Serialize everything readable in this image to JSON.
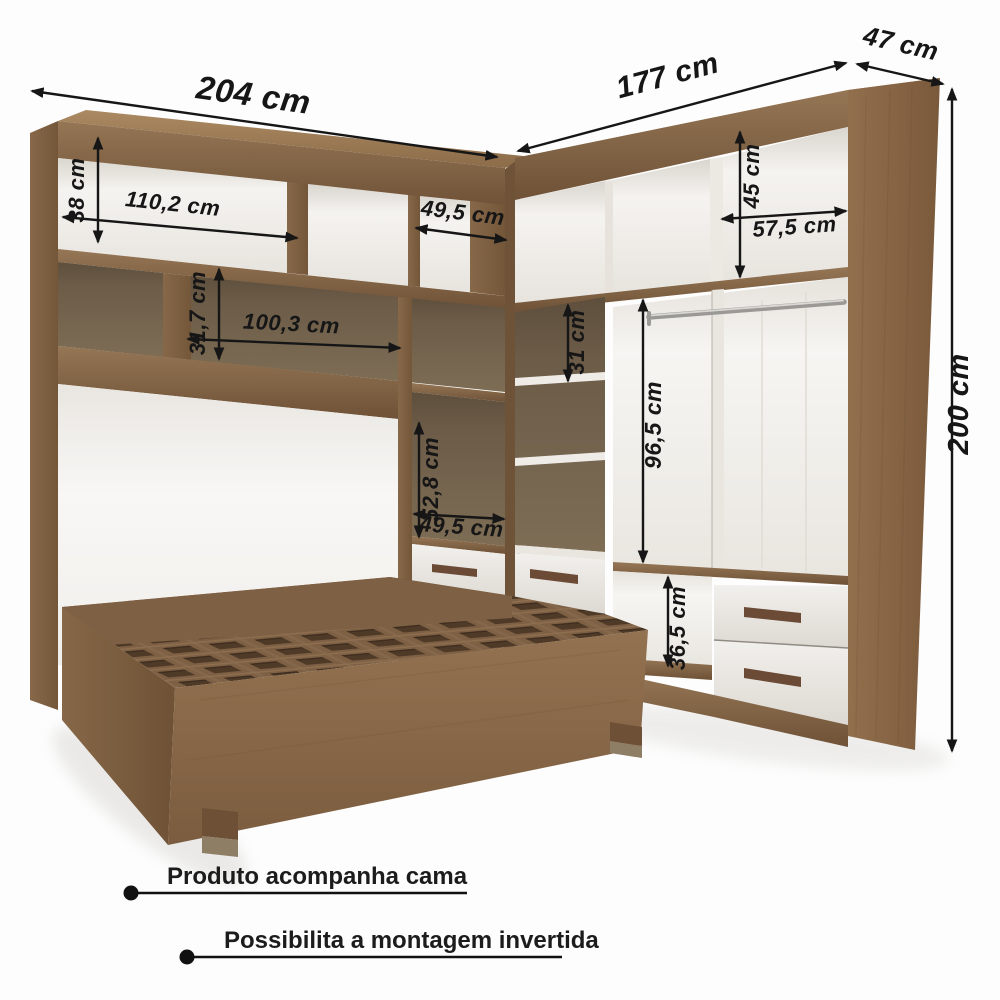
{
  "dimensions": {
    "left_width": "204 cm",
    "right_width": "177 cm",
    "right_depth": "47 cm",
    "height": "200 cm",
    "top_cubby_height": "38 cm",
    "top_cubby_width": "110,2 cm",
    "top_small_cubby_width": "49,5 cm",
    "right_cubby_height": "45 cm",
    "right_cubby_width": "57,5 cm",
    "mid_shelf_height": "31,7 cm",
    "opening_width": "100,3 cm",
    "side_column_height": "52,8 cm",
    "side_column_width": "49,5 cm",
    "right_shelf_gap": "31 cm",
    "hanging_height": "96,5 cm",
    "niche_height": "36,5 cm"
  },
  "notes": [
    {
      "text": "Produto acompanha cama"
    },
    {
      "text": "Possibilita a montagem invertida"
    }
  ],
  "colors": {
    "wood": "#82644a",
    "wood_dark": "#6a5138",
    "wood_light": "#9a7a58",
    "interior_dark": "#6e5e48",
    "panel_white": "#f2f0ed",
    "drawer_white": "#ebe9e4",
    "handle": "#6b4a36",
    "arrow": "#161616",
    "background": "#fdfdfd"
  }
}
